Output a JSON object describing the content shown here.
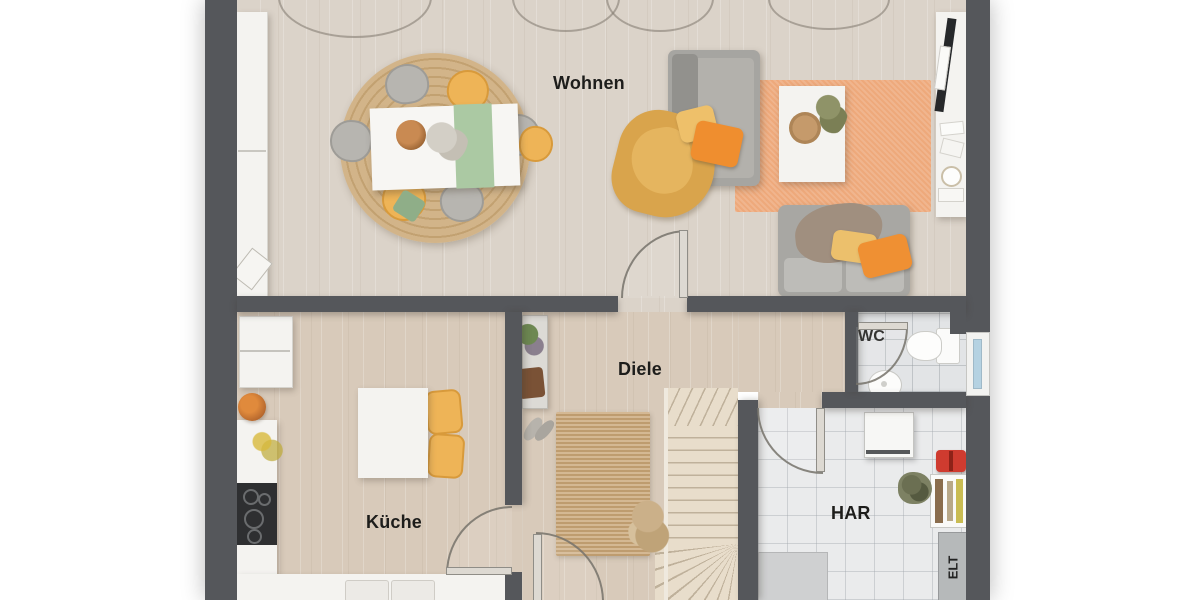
{
  "plan": {
    "title": "Erdgeschoss Grundriss",
    "rooms": {
      "wohnen": {
        "label": "Wohnen"
      },
      "diele": {
        "label": "Diele"
      },
      "kueche": {
        "label": "Küche"
      },
      "wc": {
        "label": "WC"
      },
      "har": {
        "label": "HAR"
      },
      "elt": {
        "label": "ELT"
      }
    },
    "furniture": {
      "wohnen": [
        "sideboard",
        "round-jute-rug",
        "dining-table",
        "green-table-runner",
        "gray-chairs",
        "yellow-chairs",
        "sofa",
        "sofa-2",
        "orange-rug",
        "coffee-table",
        "tv-board",
        "tv",
        "plants"
      ],
      "kueche": [
        "fridge",
        "counter",
        "cooktop",
        "fruit-bowl",
        "small-table",
        "yellow-chairs",
        "sink-counter"
      ],
      "diele": [
        "console-shelf",
        "jute-rug",
        "staircase",
        "dried-plant",
        "shoes"
      ],
      "wc": [
        "toilet",
        "washbasin",
        "plant",
        "window"
      ],
      "har": [
        "boiler",
        "toolbox",
        "shelf",
        "appliance"
      ]
    },
    "colors": {
      "wall": "#55575b",
      "wood_floor": "#dbd3c9",
      "kitchen_floor": "#d8caba",
      "tile_floor": "#e2e4e6",
      "sofa_gray": "#a6a5a1",
      "rug_orange": "#eea97b",
      "rug_jute": "#c9a678",
      "accent_yellow": "#eeb457",
      "accent_orange": "#ef8e2f",
      "accent_green": "#abc9a3",
      "window_glass": "#b5d2e2",
      "background": "#ffffff"
    }
  }
}
